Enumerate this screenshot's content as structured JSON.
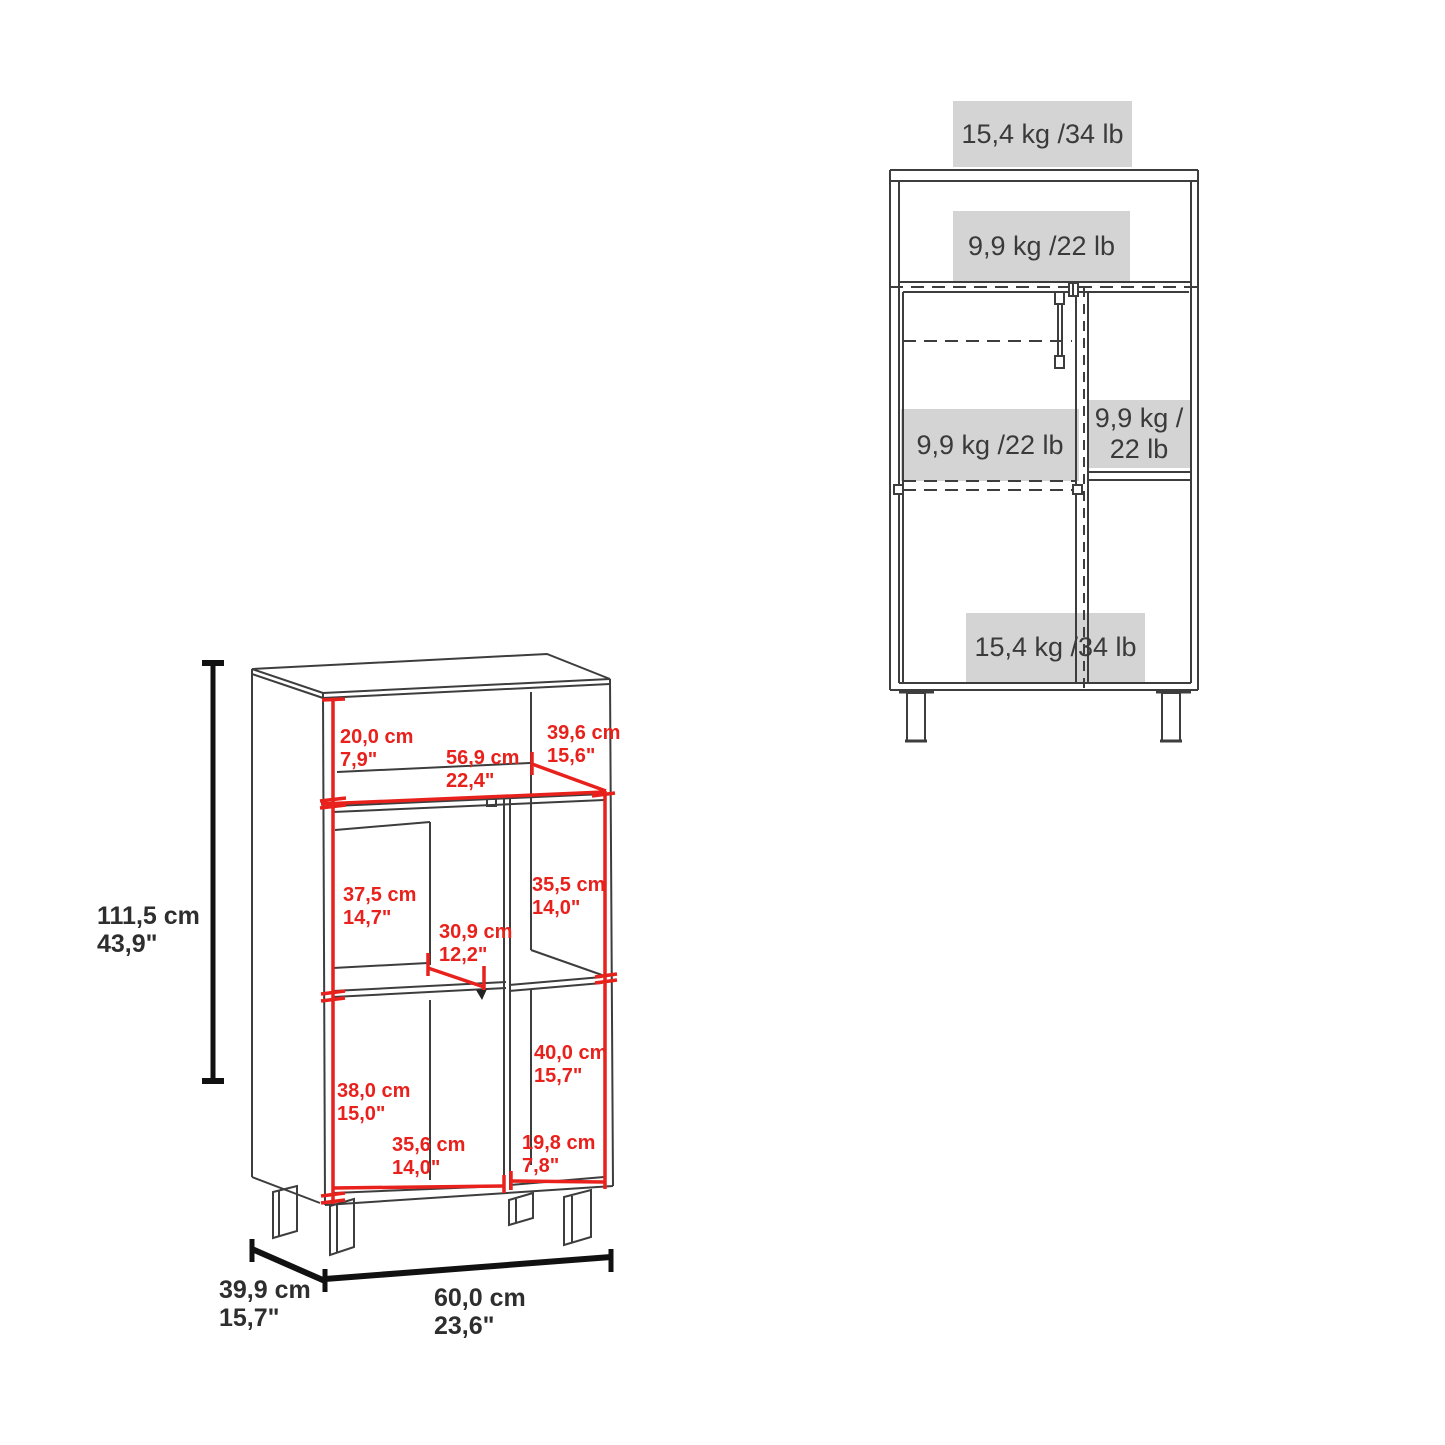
{
  "colors": {
    "dimension_red": "#e8211c",
    "line_dark": "#3d3d3d",
    "capacity_box_bg": "#d4d4d4",
    "text_dark": "#3a3a3a",
    "background": "#ffffff"
  },
  "left_diagram": {
    "description": "3D line drawing of open cabinet with red and black dimension lines",
    "overall_height": {
      "metric": "111,5 cm",
      "imperial": "43,9\""
    },
    "top_opening_height": {
      "metric": "20,0 cm",
      "imperial": "7,9\""
    },
    "top_shelf_width": {
      "metric": "56,9 cm",
      "imperial": "22,4\""
    },
    "top_shelf_depth": {
      "metric": "39,6 cm",
      "imperial": "15,6\""
    },
    "upper_left_compartment_height": {
      "metric": "37,5 cm",
      "imperial": "14,7\""
    },
    "center_compartment_width": {
      "metric": "30,9 cm",
      "imperial": "12,2\""
    },
    "upper_right_compartment_height": {
      "metric": "35,5 cm",
      "imperial": "14,0\""
    },
    "lower_left_compartment_height": {
      "metric": "38,0 cm",
      "imperial": "15,0\""
    },
    "lower_right_compartment_height": {
      "metric": "40,0 cm",
      "imperial": "15,7\""
    },
    "lower_left_compartment_width": {
      "metric": "35,6 cm",
      "imperial": "14,0\""
    },
    "lower_right_compartment_width": {
      "metric": "19,8 cm",
      "imperial": "7,8\""
    },
    "overall_depth": {
      "metric": "39,9 cm",
      "imperial": "15,7\""
    },
    "overall_width": {
      "metric": "60,0 cm",
      "imperial": "23,6\""
    }
  },
  "right_diagram": {
    "description": "Front view of cabinet with maximum load capacity labels",
    "top_surface_capacity": "15,4 kg /34 lb",
    "upper_shelf_capacity": "9,9 kg /22 lb",
    "middle_left_shelf_capacity": "9,9 kg /22 lb",
    "middle_right_shelf_capacity": {
      "line1": "9,9 kg /",
      "line2": "22 lb"
    },
    "bottom_shelf_capacity": "15,4 kg /34 lb"
  }
}
